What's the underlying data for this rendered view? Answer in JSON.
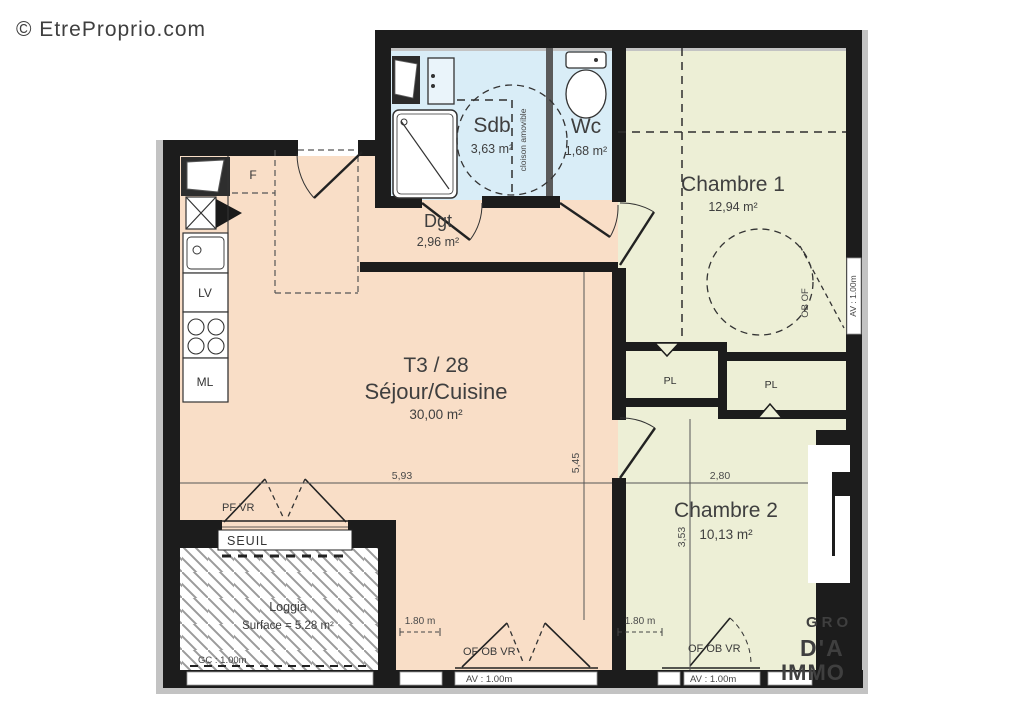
{
  "watermarks": {
    "site": "© EtreProprio.com",
    "agency_line1": "GRO",
    "agency_line2": "D'A",
    "agency_line3": "IMMO"
  },
  "unit_label": "T3 / 28",
  "rooms": {
    "sdb": {
      "name": "Sdb",
      "area": "3,63 m²"
    },
    "wc": {
      "name": "Wc",
      "area": "1,68 m²"
    },
    "chambre1": {
      "name": "Chambre 1",
      "area": "12,94 m²"
    },
    "dgt": {
      "name": "Dgt",
      "area": "2,96 m²"
    },
    "sejour": {
      "name": "Séjour/Cuisine",
      "area": "30,00 m²"
    },
    "chambre2": {
      "name": "Chambre 2",
      "area": "10,13 m²"
    },
    "loggia": {
      "name": "Loggia",
      "area": "Surface = 5.28 m²"
    }
  },
  "fixtures": {
    "fridge": "F",
    "dishwasher": "LV",
    "washer": "ML",
    "closet_left": "PL",
    "closet_right": "PL"
  },
  "annotations": {
    "cloison": "cloison amovible",
    "seuil": "SEUIL",
    "pf_vr": "PF VR",
    "gc": "GC : 1.00m",
    "of_ob_vr_sejour": "OF OB VR",
    "of_ob_vr_chambre2": "OF OB VR",
    "av_sejour": "AV : 1.00m",
    "av_chambre2": "AV : 1.00m",
    "av_chambre1": "AV : 1.00m",
    "ob_of": "OB OF"
  },
  "dimensions": {
    "sejour_w": "5,93",
    "sejour_h": "5,45",
    "chambre2_w": "2,80",
    "chambre2_h": "3,53",
    "win_sejour": "1.80 m",
    "win_chambre2": "1.80 m"
  },
  "colors": {
    "wall": "#1c1c1c",
    "sejour": "#f9dec7",
    "bedroom": "#edefd6",
    "bath": "#d9edf7",
    "trim": "#c3c3c3",
    "hatch": "#9b9b9b",
    "watermark_gray": "#dcdcdc",
    "watermark_white": "#ffffff"
  }
}
